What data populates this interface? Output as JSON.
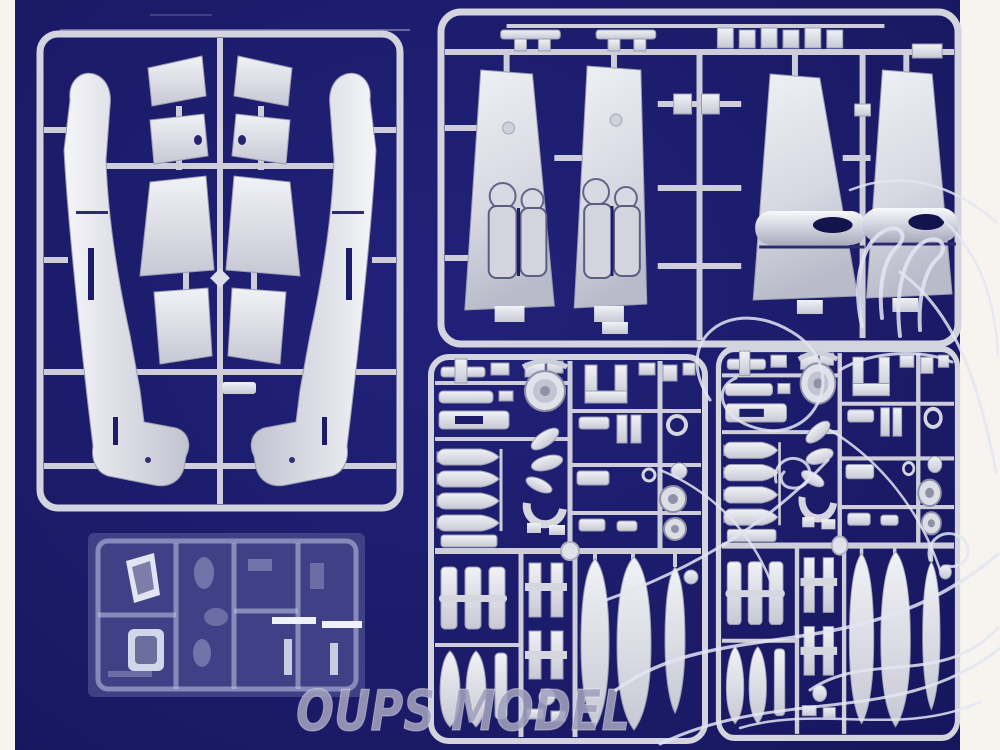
{
  "photo": {
    "description": "Plastic scale-model aircraft kit sprues photographed on a dark navy background",
    "background_color": "#1c1c6b",
    "mat_color": "#f7f4ef",
    "plastic_color": "#d8d9e2"
  },
  "watermark": {
    "text": "OUPS MODEL",
    "color": "#a2a1bd"
  },
  "ornament": {
    "name": "floral-swirl-line-art",
    "color": "#e3e5f2"
  },
  "sprues": [
    {
      "id": "A",
      "position": "top-left",
      "contents": "two fuselage halves and eight wing / tailplane panels"
    },
    {
      "id": "B",
      "position": "top-right",
      "contents": "four large wing panels with landing-gear bays and engine nacelles plus a row of small clips"
    },
    {
      "id": "C",
      "position": "bottom-center",
      "contents": "bombs, drop tanks, wheels, propeller blades and landing-gear small parts"
    },
    {
      "id": "D",
      "position": "bottom-right",
      "contents": "duplicate small-parts sprue"
    },
    {
      "id": "E",
      "position": "bottom-left",
      "contents": "clear canopy parts sprue"
    }
  ]
}
